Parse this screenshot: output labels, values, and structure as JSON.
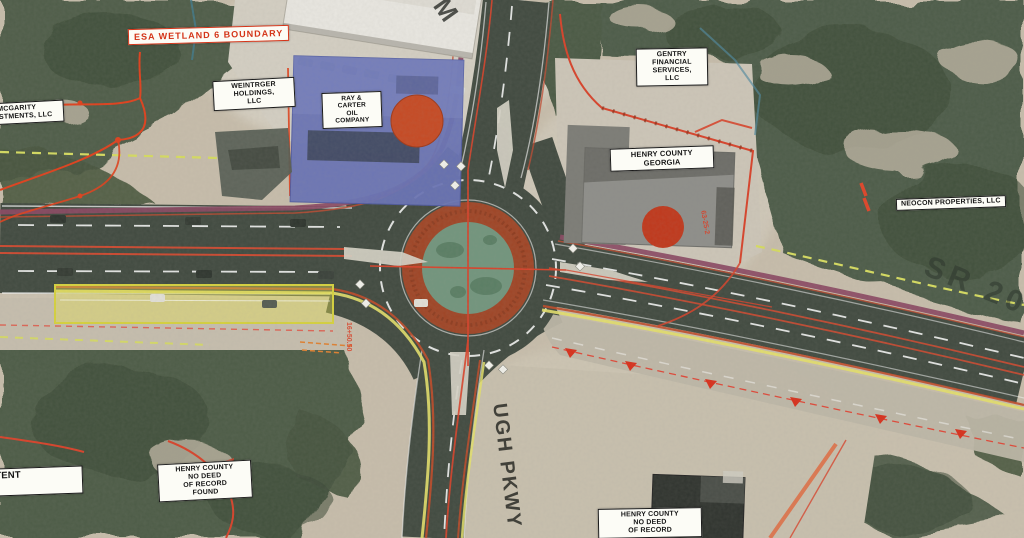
{
  "labels": {
    "mcgarity": {
      "lines": [
        "MCGARITY",
        "INVESTMENTS, LLC"
      ]
    },
    "esa_wetland": {
      "lines": [
        "ESA WETLAND 6 BOUNDARY"
      ]
    },
    "weintrger": {
      "lines": [
        "WEINTRGER",
        "HOLDINGS,",
        "LLC"
      ]
    },
    "ray_carter": {
      "lines": [
        "RAY &",
        "CARTER",
        "OIL",
        "COMPANY"
      ]
    },
    "gentry": {
      "lines": [
        "GENTRY",
        "FINANCIAL",
        "SERVICES,",
        "LLC"
      ]
    },
    "henry_county_georgia": {
      "lines": [
        "HENRY COUNTY",
        "GEORGIA"
      ]
    },
    "neocon": {
      "lines": [
        "NEOCON PROPERTIES, LLC"
      ]
    },
    "intermittent_stream": {
      "lines": [
        "INTERMITTENT",
        "STREAM B"
      ]
    },
    "henry_no_deed_west": {
      "lines": [
        "HENRY COUNTY",
        "NO DEED",
        "OF RECORD",
        "FOUND"
      ]
    },
    "henry_no_deed_south": {
      "lines": [
        "HENRY COUNTY",
        "NO DEED",
        "OF RECORD"
      ]
    }
  },
  "road_labels": {
    "mcdonough_pkwy": "UGH PKWY",
    "sr20": "SR 20",
    "partial_top": "M"
  },
  "annotations": {
    "parcel_id": "63-25-2",
    "station": "16+50.50"
  },
  "colors": {
    "wetland_red": "#d8422a",
    "esa_text": "#d43418",
    "boundary_dash_yellow": "#d6dc60",
    "highlight_yellow": "#e8e450",
    "apron_red": "#9f4526",
    "island_green": "#72957d",
    "maroon_edge": "#8a4862",
    "building_blue": "#6973b5"
  }
}
